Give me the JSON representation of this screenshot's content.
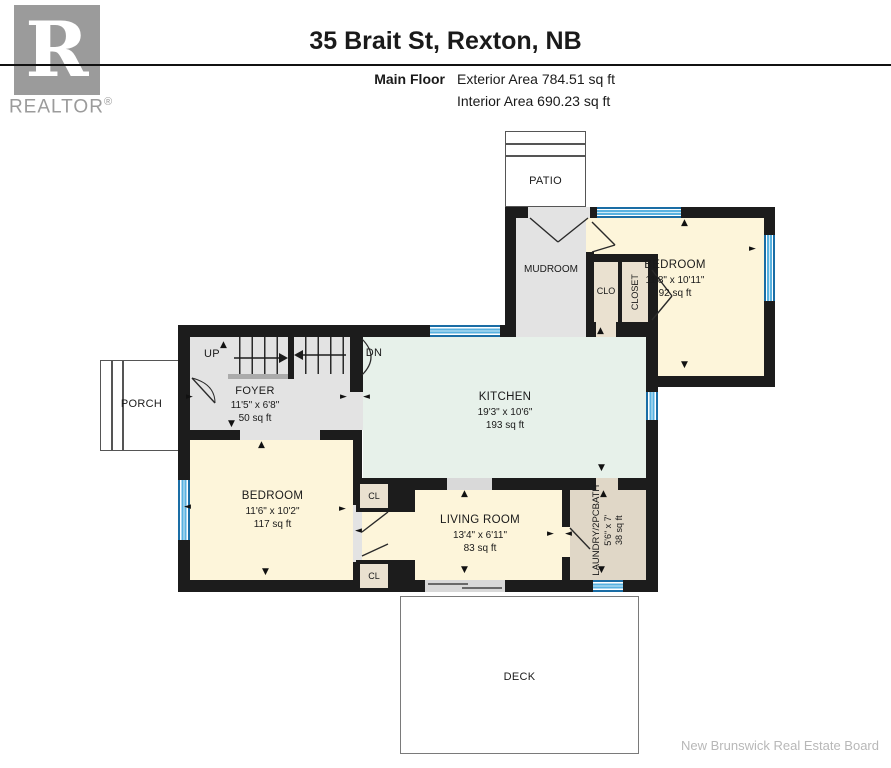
{
  "header": {
    "title": "35 Brait St, Rexton, NB",
    "floor_label": "Main Floor",
    "exterior_area": "Exterior Area 784.51 sq ft",
    "interior_area": "Interior Area 690.23 sq ft",
    "logo": {
      "letter": "R",
      "name": "REALTOR",
      "registered": "®"
    }
  },
  "rooms": {
    "patio": {
      "label": "PATIO"
    },
    "mudroom": {
      "label": "MUDROOM"
    },
    "bedroom_ne": {
      "label": "BEDROOM",
      "dims": "11'8\" x 10'11\"",
      "area": "92 sq ft"
    },
    "clo": {
      "label": "CLO"
    },
    "closet": {
      "label": "CLOSET"
    },
    "porch": {
      "label": "PORCH"
    },
    "foyer": {
      "label": "FOYER",
      "dims": "11'5\" x 6'8\"",
      "area": "50 sq ft"
    },
    "kitchen": {
      "label": "KITCHEN",
      "dims": "19'3\" x 10'6\"",
      "area": "193 sq ft"
    },
    "bedroom_sw": {
      "label": "BEDROOM",
      "dims": "11'6\" x 10'2\"",
      "area": "117 sq ft"
    },
    "living_room": {
      "label": "LIVING ROOM",
      "dims": "13'4\" x 6'11\"",
      "area": "83 sq ft"
    },
    "laundry": {
      "label": "LAUNDRY/2PCBATH",
      "dims": "5'6\" x 7'",
      "area": "38 sq ft"
    },
    "closet_top": {
      "label": "CL"
    },
    "closet_bottom": {
      "label": "CL"
    },
    "deck": {
      "label": "DECK"
    }
  },
  "stairs": {
    "up": "UP",
    "down": "DN"
  },
  "glyphs": {
    "up": "▲",
    "down": "▼",
    "left": "◄",
    "right": "►"
  },
  "colors": {
    "wall": "#1c1c1c",
    "floor_gray": "#e3e3e3",
    "floor_cream": "#fdf5da",
    "floor_mint": "#e7f1ea",
    "floor_tan": "#e0d7c7",
    "window_blue": "#59b2e0",
    "logo_gray": "#9b9b9b"
  },
  "arrows": [
    {
      "g": "up",
      "x": 220,
      "y": 341
    },
    {
      "g": "right",
      "x": 340,
      "y": 393
    },
    {
      "g": "left",
      "x": 363,
      "y": 393
    },
    {
      "g": "down",
      "x": 228,
      "y": 420
    },
    {
      "g": "up",
      "x": 258,
      "y": 441
    },
    {
      "g": "up",
      "x": 597,
      "y": 327
    },
    {
      "g": "up",
      "x": 681,
      "y": 219
    },
    {
      "g": "right",
      "x": 749,
      "y": 245
    },
    {
      "g": "down",
      "x": 681,
      "y": 361
    },
    {
      "g": "down",
      "x": 598,
      "y": 464
    },
    {
      "g": "up",
      "x": 600,
      "y": 490
    },
    {
      "g": "right",
      "x": 547,
      "y": 530
    },
    {
      "g": "left",
      "x": 565,
      "y": 530
    },
    {
      "g": "down",
      "x": 598,
      "y": 566
    },
    {
      "g": "up",
      "x": 461,
      "y": 490
    },
    {
      "g": "down",
      "x": 461,
      "y": 566
    },
    {
      "g": "right",
      "x": 339,
      "y": 505
    },
    {
      "g": "left",
      "x": 355,
      "y": 527
    },
    {
      "g": "left",
      "x": 184,
      "y": 503
    },
    {
      "g": "down",
      "x": 262,
      "y": 568
    },
    {
      "g": "right",
      "x": 186,
      "y": 393
    }
  ],
  "footer": {
    "attribution": "New Brunswick Real Estate Board"
  }
}
